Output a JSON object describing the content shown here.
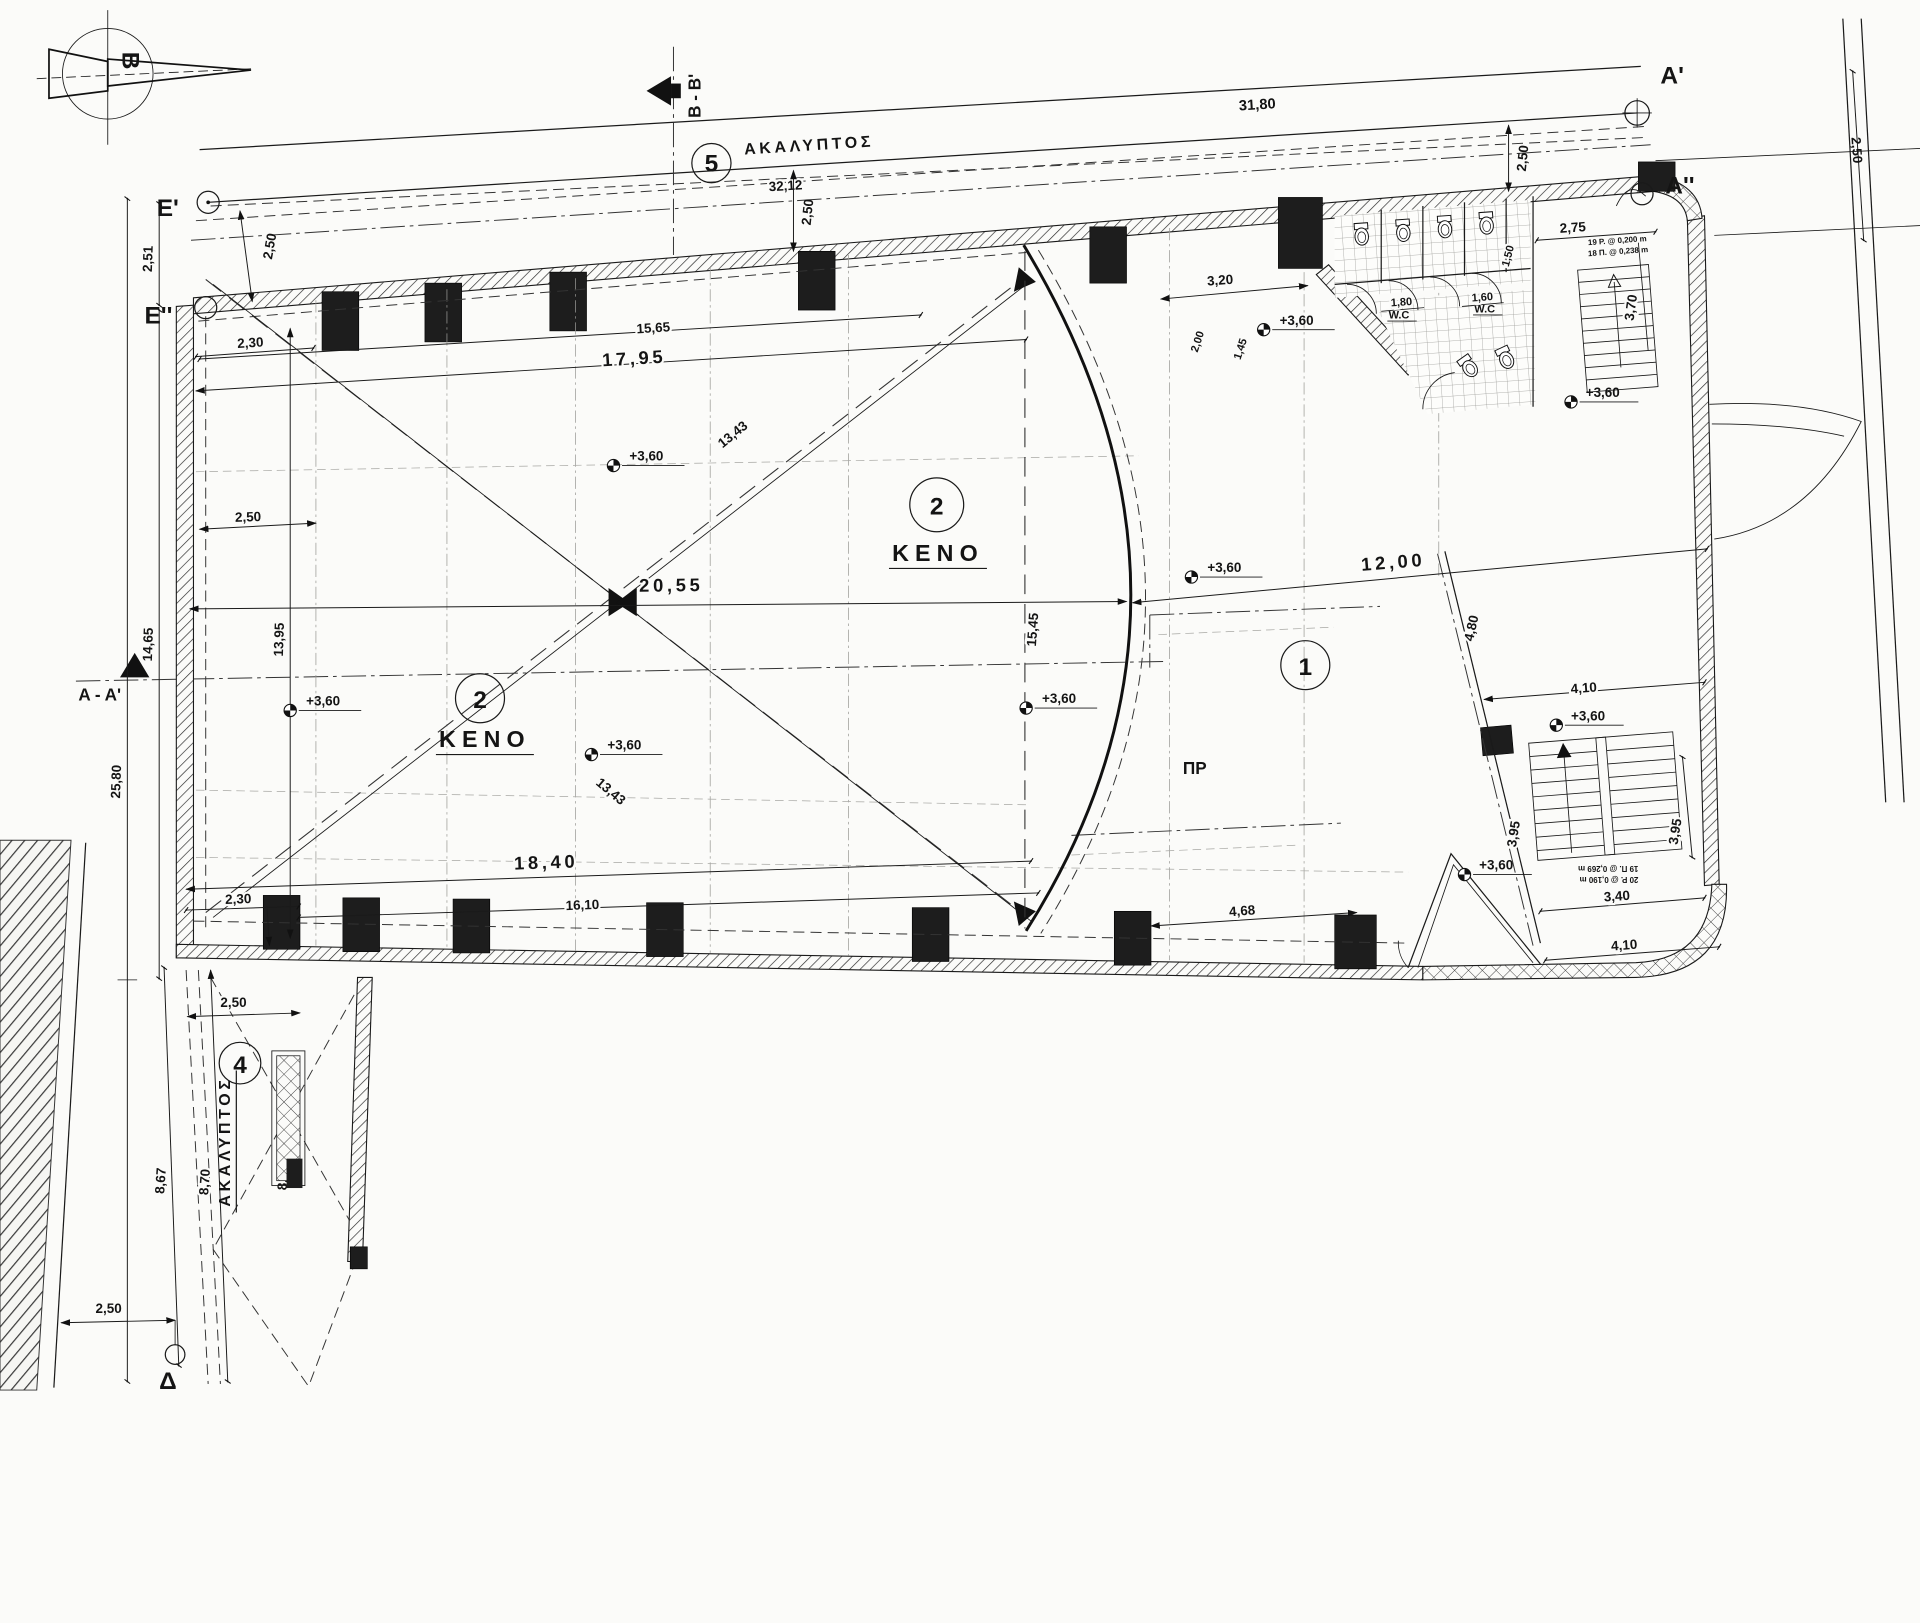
{
  "meta": {
    "type": "architectural-floor-plan",
    "language": "el"
  },
  "north": {
    "letter": "B"
  },
  "sections": {
    "bb": "B - B'",
    "aa": "A - A'"
  },
  "markers": {
    "a1": "A'",
    "a2": "A''",
    "e1": "E'",
    "e2": "E''",
    "delta": "Δ"
  },
  "regions": {
    "r1": "1",
    "r2": "2",
    "r4": "4",
    "r5": "5",
    "keno": "KENO",
    "akalyptos": "ΑΚΑΛΥΠΤΟΣ",
    "pr": "ΠΡ",
    "wc": "W.C"
  },
  "elevation": {
    "value": "+3,60"
  },
  "stair_notes": {
    "upper1": "19 P. @ 0,200 m",
    "upper2": "18 Π. @ 0,238 m",
    "main1": "20 P. @ 0,190 m",
    "main2": "19 Π. @ 0,269 m"
  },
  "dims": {
    "d31_80": "31,80",
    "d32_12": "32,12",
    "d2_50": "2,50",
    "d2_51": "2,51",
    "d2_30": "2,30",
    "d15_65": "15,65",
    "d17_95": "17,95",
    "d3_20": "3,20",
    "d1_80": "1,80",
    "d1_60": "1,60",
    "d1_50": "1,50",
    "d2_75": "2,75",
    "d3_70": "3,70",
    "d2_00": "2,00",
    "d1_45": "1,45",
    "d13_43": "13,43",
    "d20_55": "20,55",
    "d13_95": "13,95",
    "d14_65": "14,65",
    "d25_80": "25,80",
    "d15_45": "15,45",
    "d12_00": "12,00",
    "d4_80": "4,80",
    "d4_10": "4,10",
    "d3_95": "3,95",
    "d3_40": "3,40",
    "d4_68": "4,68",
    "d18_40": "18,40",
    "d16_10": "16,10",
    "d8_67": "8,67",
    "d8_70": "8,70",
    "d8_66": "8,66"
  }
}
